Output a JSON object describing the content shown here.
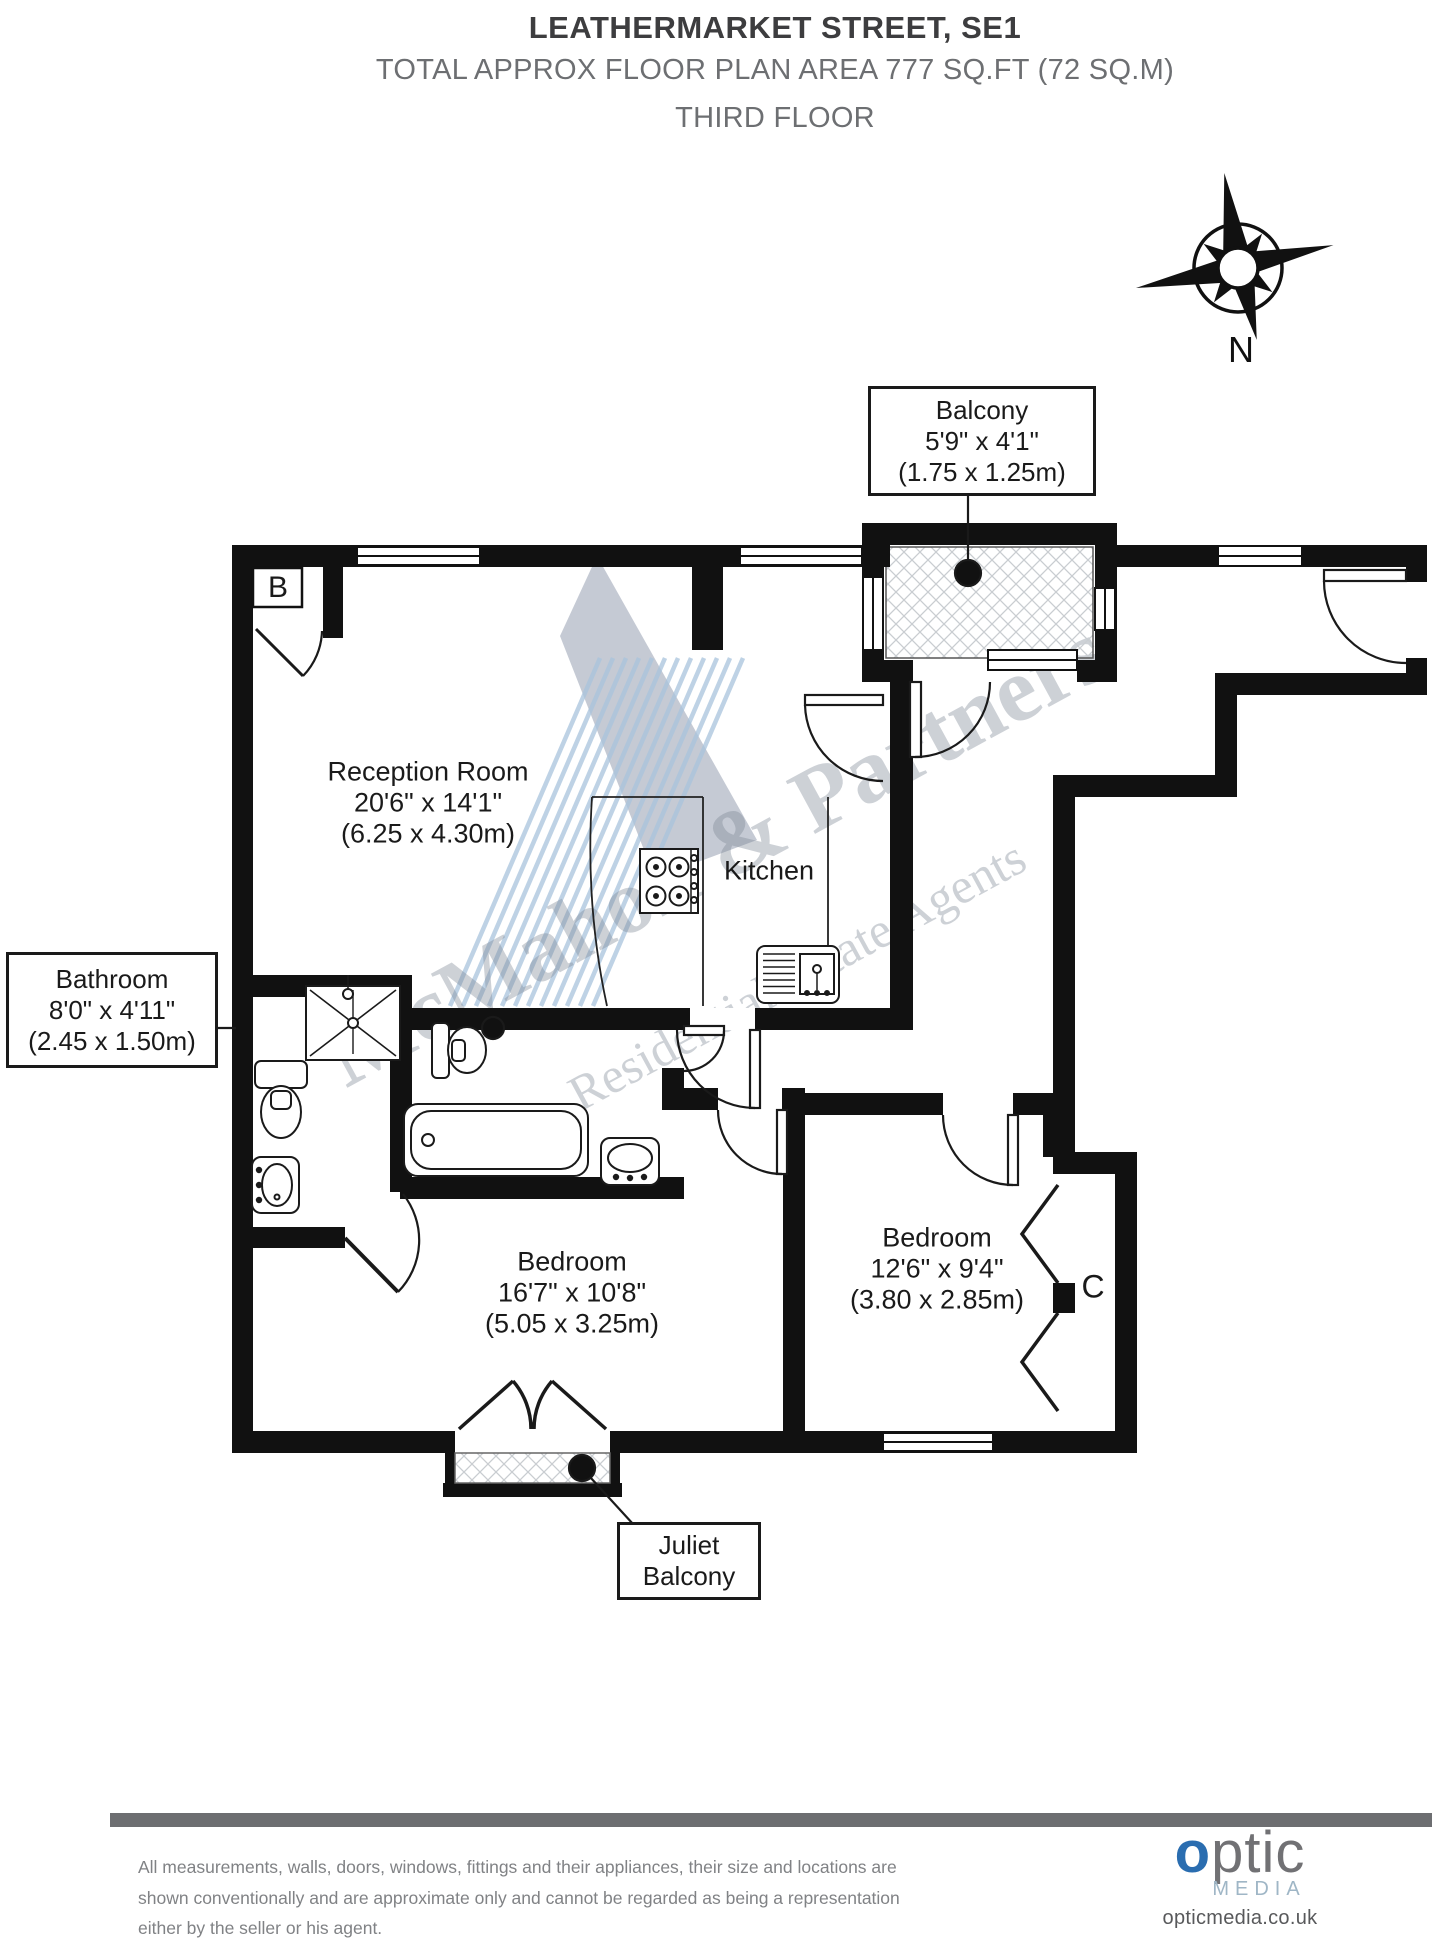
{
  "header": {
    "address": "LEATHERMARKET STREET, SE1",
    "area_line": "TOTAL APPROX FLOOR PLAN AREA 777 SQ.FT (72 SQ.M)",
    "floor_line": "THIRD FLOOR"
  },
  "compass": {
    "label": "N"
  },
  "labels": {
    "balcony": {
      "name": "Balcony",
      "imperial": "5'9\" x 4'1\"",
      "metric": "(1.75 x 1.25m)"
    },
    "bathroom": {
      "name": "Bathroom",
      "imperial": "8'0\" x 4'11\"",
      "metric": "(2.45 x 1.50m)"
    },
    "juliet": {
      "line1": "Juliet",
      "line2": "Balcony"
    }
  },
  "rooms": {
    "reception": {
      "name": "Reception Room",
      "imperial": "20'6\" x 14'1\"",
      "metric": "(6.25 x 4.30m)"
    },
    "kitchen": {
      "name": "Kitchen"
    },
    "bedroom1": {
      "name": "Bedroom",
      "imperial": "16'7\" x 10'8\"",
      "metric": "(5.05 x 3.25m)"
    },
    "bedroom2": {
      "name": "Bedroom",
      "imperial": "12'6\" x 9'4\"",
      "metric": "(3.80 x 2.85m)"
    },
    "cupboard_b": "B",
    "cupboard_c": "C"
  },
  "watermark": {
    "line1": "McMahon & Partners",
    "line2": "Residential Estate Agents"
  },
  "footer": {
    "disclaimer_line1": "All measurements, walls, doors, windows, fittings and their appliances, their size and locations are",
    "disclaimer_line2": "shown conventionally and are approximate only and cannot be regarded as being a representation",
    "disclaimer_line3": "either by the seller or his agent.",
    "logo_o": "o",
    "logo_rest": "ptic",
    "logo_sub": "MEDIA",
    "website": "opticmedia.co.uk"
  },
  "colors": {
    "wall": "#111111",
    "accent_blue": "#2a6db0",
    "footer_gray": "#6d6e71",
    "watermark_gray": "#7d8795"
  }
}
